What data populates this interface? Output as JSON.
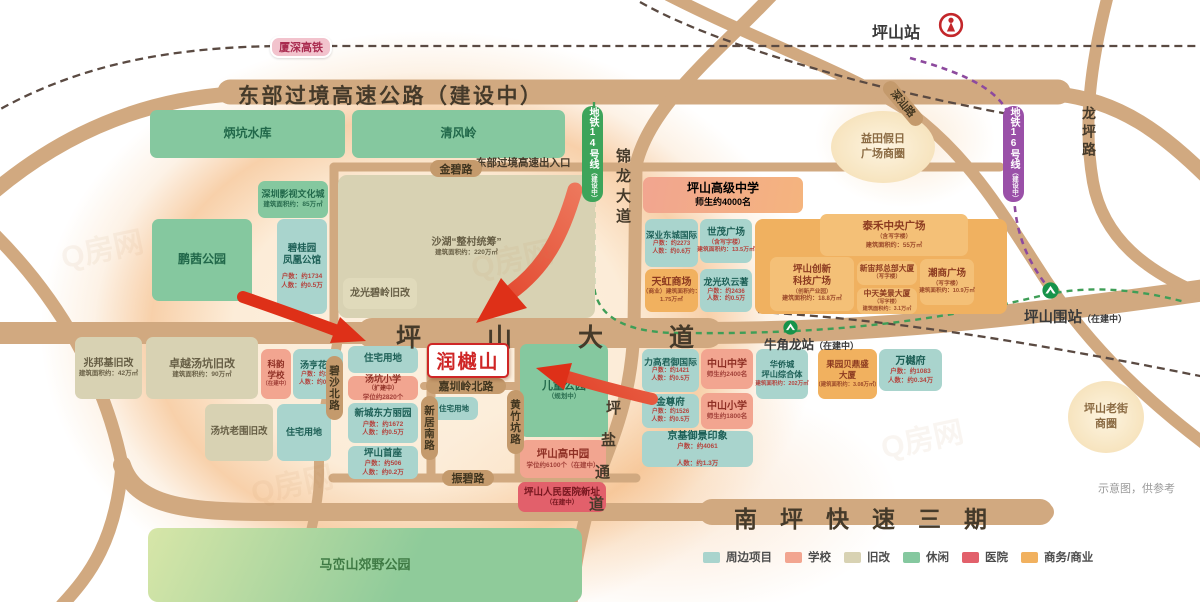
{
  "meta": {
    "note": "示意图，供参考",
    "watermark": "Q房网"
  },
  "project": {
    "name": "润樾山",
    "accent": "#cf2626"
  },
  "legend": {
    "items": [
      {
        "label": "周边项目",
        "color": "#a9d4cd"
      },
      {
        "label": "学校",
        "color": "#f2a590"
      },
      {
        "label": "旧改",
        "color": "#d8d2b3"
      },
      {
        "label": "休闲",
        "color": "#85c89f"
      },
      {
        "label": "医院",
        "color": "#e2606b"
      },
      {
        "label": "商务/商业",
        "color": "#f1b15f"
      }
    ]
  },
  "rails": {
    "xiashen": "厦深高铁",
    "metro14": "地铁14号线",
    "metro14_status": "（建设中）",
    "metro16": "地铁16号线",
    "metro16_status": "（建设中）"
  },
  "stations": {
    "pingshan": {
      "name": "坪山站"
    },
    "niujiaolong": {
      "name": "牛角龙站",
      "status": "（在建中）"
    },
    "pingshanwei": {
      "name": "坪山围站",
      "status": "（在建中）"
    }
  },
  "roads": {
    "dongbu": "东部过境高速公路（建设中）",
    "chukou": "东部过境高速出入口",
    "jinbi": "金碧路",
    "pingshandadao": "坪山大道",
    "nanping": "南坪快速三期",
    "jinlong": "锦龙大道",
    "longping": "龙坪路",
    "shenshan": "深汕路",
    "zhenbi": "振碧路",
    "jiazhenling": "嘉圳岭北路",
    "xinju": "新居南路",
    "huangzhukeng": "黄竹坑路",
    "bisha": "碧沙北路",
    "pingyan_chars": [
      "坪",
      "盐",
      "通",
      "道"
    ]
  },
  "areas": {
    "yitian": {
      "line1": "益田假日",
      "line2": "广场商圈"
    },
    "laojie": {
      "line1": "坪山老街",
      "line2": "商圈"
    }
  },
  "blocks": {
    "residential": "住宅用地",
    "bingkeng": {
      "title": "炳坑水库"
    },
    "qingfeng": {
      "title": "清风岭"
    },
    "yingshi": {
      "title": "深圳影视文化城",
      "sub": "建筑面积约：85万㎡"
    },
    "pengqian": {
      "title": "鹏茜公园"
    },
    "shahu": {
      "title": "沙湖“整村统筹”",
      "sub": "建筑面积约：220万㎡"
    },
    "longguangbiling": {
      "title": "龙光碧岭旧改"
    },
    "biguiyuan": {
      "t1": "碧桂园",
      "t2": "凤凰公馆",
      "s1": "户数：约1734",
      "s2": "人数：约0.5万"
    },
    "tangkengxiaoxue": {
      "title": "汤坑小学",
      "badge": "（扩建中）",
      "sub": "学位约2820个"
    },
    "xincheng": {
      "title": "新城东方丽园",
      "s1": "户数：约1672",
      "s2": "人数：约0.5万"
    },
    "shouzuo": {
      "title": "坪山首座",
      "s1": "户数：约506",
      "s2": "人数：约0.2万"
    },
    "ertong": {
      "title": "儿童公园",
      "sub": "（规划中）"
    },
    "gaozhongyuan": {
      "title": "坪山高中园",
      "sub": "学位约6100个（在建中）"
    },
    "hospital": {
      "title": "坪山人民医院新址",
      "sub": "（在建中）"
    },
    "maluan": {
      "title": "马峦山郊野公园"
    },
    "zhaobangji": {
      "title": "兆邦基旧改",
      "sub": "建筑面积约：42万㎡"
    },
    "zhuoyue": {
      "title": "卓越汤坑旧改",
      "sub": "建筑面积约：90万㎡"
    },
    "keyun": {
      "t1": "科韵",
      "t2": "学校",
      "s": "（在建中）"
    },
    "tangheng": {
      "title": "汤亨花园",
      "s1": "户数：约342",
      "s2": "人数：约0.2万"
    },
    "tangkenglaowei": {
      "title": "汤坑老围旧改"
    },
    "gaojizhongxue": {
      "title": "坪山高级中学",
      "sub": "师生约4000名"
    },
    "shenye": {
      "title": "深业东城国际",
      "s1": "户数：约2273",
      "s2": "人数：约0.6万"
    },
    "shimao": {
      "title": "世茂广场",
      "s0": "（含写字楼）",
      "sub": "建筑面积约：13.5万㎡"
    },
    "tianhong": {
      "title": "天虹商场",
      "s1": "（商业）建筑面积约：",
      "s2": "1.75万㎡"
    },
    "longguangjiu": {
      "title": "龙光玖云著",
      "s1": "户数：约2436",
      "s2": "人数：约0.5万"
    },
    "taihe": {
      "title": "泰禾中央广场",
      "s0": "（含写字楼）",
      "sub": "建筑面积约：55万㎡"
    },
    "chuangxin": {
      "t1": "坪山创新",
      "t2": "科技广场",
      "s0": "（创新产业园）",
      "sub": "建筑面积约：18.8万㎡"
    },
    "xinzhoubang": {
      "title": "新宙邦总部大厦",
      "s0": "（写字楼）"
    },
    "zhongtian": {
      "title": "中天美景大厦",
      "s0": "（写字楼）",
      "sub": "建筑面积约：3.1万㎡"
    },
    "chaoshang": {
      "title": "潮商广场",
      "s0": "（写字楼）",
      "sub": "建筑面积约：10.9万㎡"
    },
    "ligao": {
      "title": "力高君御国际",
      "s1": "户数：约1421",
      "s2": "人数：约0.5万"
    },
    "zhongshanzhongxue": {
      "title": "中山中学",
      "sub": "师生约2400名"
    },
    "huaqiaocheng": {
      "t1": "华侨城",
      "t2": "坪山综合体",
      "sub": "建筑面积约：202万㎡"
    },
    "jinzunfu": {
      "title": "金尊府",
      "s1": "户数：约1526",
      "s2": "人数：约0.5万"
    },
    "zhongshanxiaoxue": {
      "title": "中山小学",
      "sub": "师生约1800名"
    },
    "jingji": {
      "title": "京基御景印象",
      "s1": "户数：约4061",
      "s2": "人数：约1.3万"
    },
    "guoyuan": {
      "t1": "果园贝鼎盛",
      "t2": "大厦",
      "sub": "（建筑面积约：3.08万㎡）"
    },
    "wanyuefu": {
      "title": "万樾府",
      "s1": "户数：约1083",
      "s2": "人数：约0.34万"
    }
  }
}
